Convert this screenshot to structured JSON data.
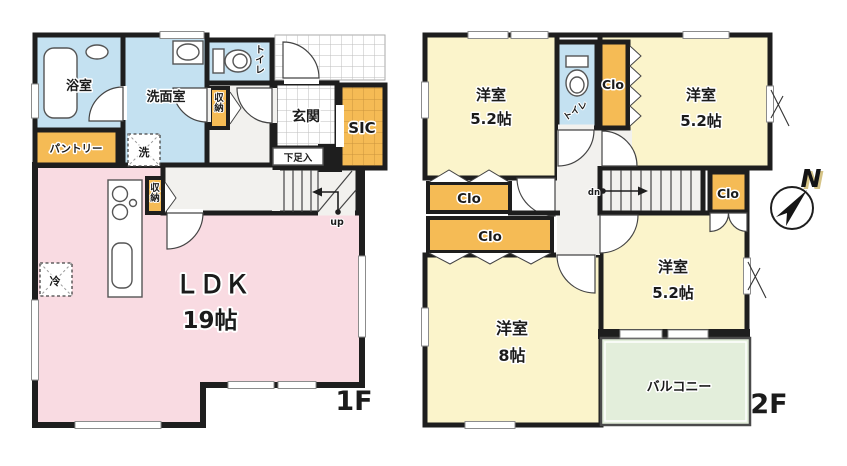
{
  "colors": {
    "paper": "#ffffff",
    "wall": "#1e1e1e",
    "pink": "#f9dbe2",
    "blue": "#c4e1f1",
    "orange": "#f5bb55",
    "yellow": "#fbf4cb",
    "green": "#e3eedb",
    "hall": "#f2f1ee",
    "grid": "#bdbdbd"
  },
  "floor1": {
    "label": "1F",
    "bath": "浴室",
    "washroom": "洗面室",
    "pantry": "パントリー",
    "washer": "洗",
    "toilet": "トイレ",
    "hall_storage": "収納",
    "kitchen_storage": "収納",
    "entrance": "玄関",
    "shoe_cabinet": "下足入",
    "sic": "SIC",
    "ldk_name": "ＬＤＫ",
    "ldk_size": "19帖",
    "fridge": "冷",
    "stairs_direction": "up"
  },
  "floor2": {
    "label": "2F",
    "room_nw_name": "洋室",
    "room_nw_size": "5.2帖",
    "room_ne_name": "洋室",
    "room_ne_size": "5.2帖",
    "room_e_name": "洋室",
    "room_e_size": "5.2帖",
    "room_s_name": "洋室",
    "room_s_size": "8帖",
    "toilet": "トイレ",
    "closet_n": "Clo",
    "closet_w1": "Clo",
    "closet_w2": "Clo",
    "closet_e": "Clo",
    "balcony": "バルコニー",
    "stairs_direction": "dn"
  },
  "compass": {
    "north": "N"
  }
}
